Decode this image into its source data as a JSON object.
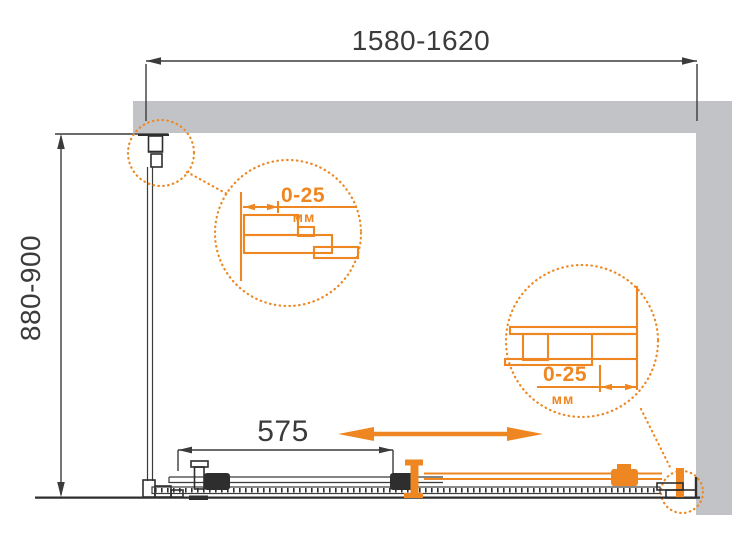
{
  "drawing": {
    "width_label": "1580-1620",
    "depth_label": "880-900",
    "door_label": "575",
    "left_detail": {
      "range": "0-25",
      "unit": "мм"
    },
    "right_detail": {
      "range": "0-25",
      "unit": "мм"
    },
    "colors": {
      "accent_orange": "#ee8722",
      "wall_gray": "#c2c3c7",
      "line_dark": "#3b3b3b",
      "background": "#ffffff"
    }
  }
}
